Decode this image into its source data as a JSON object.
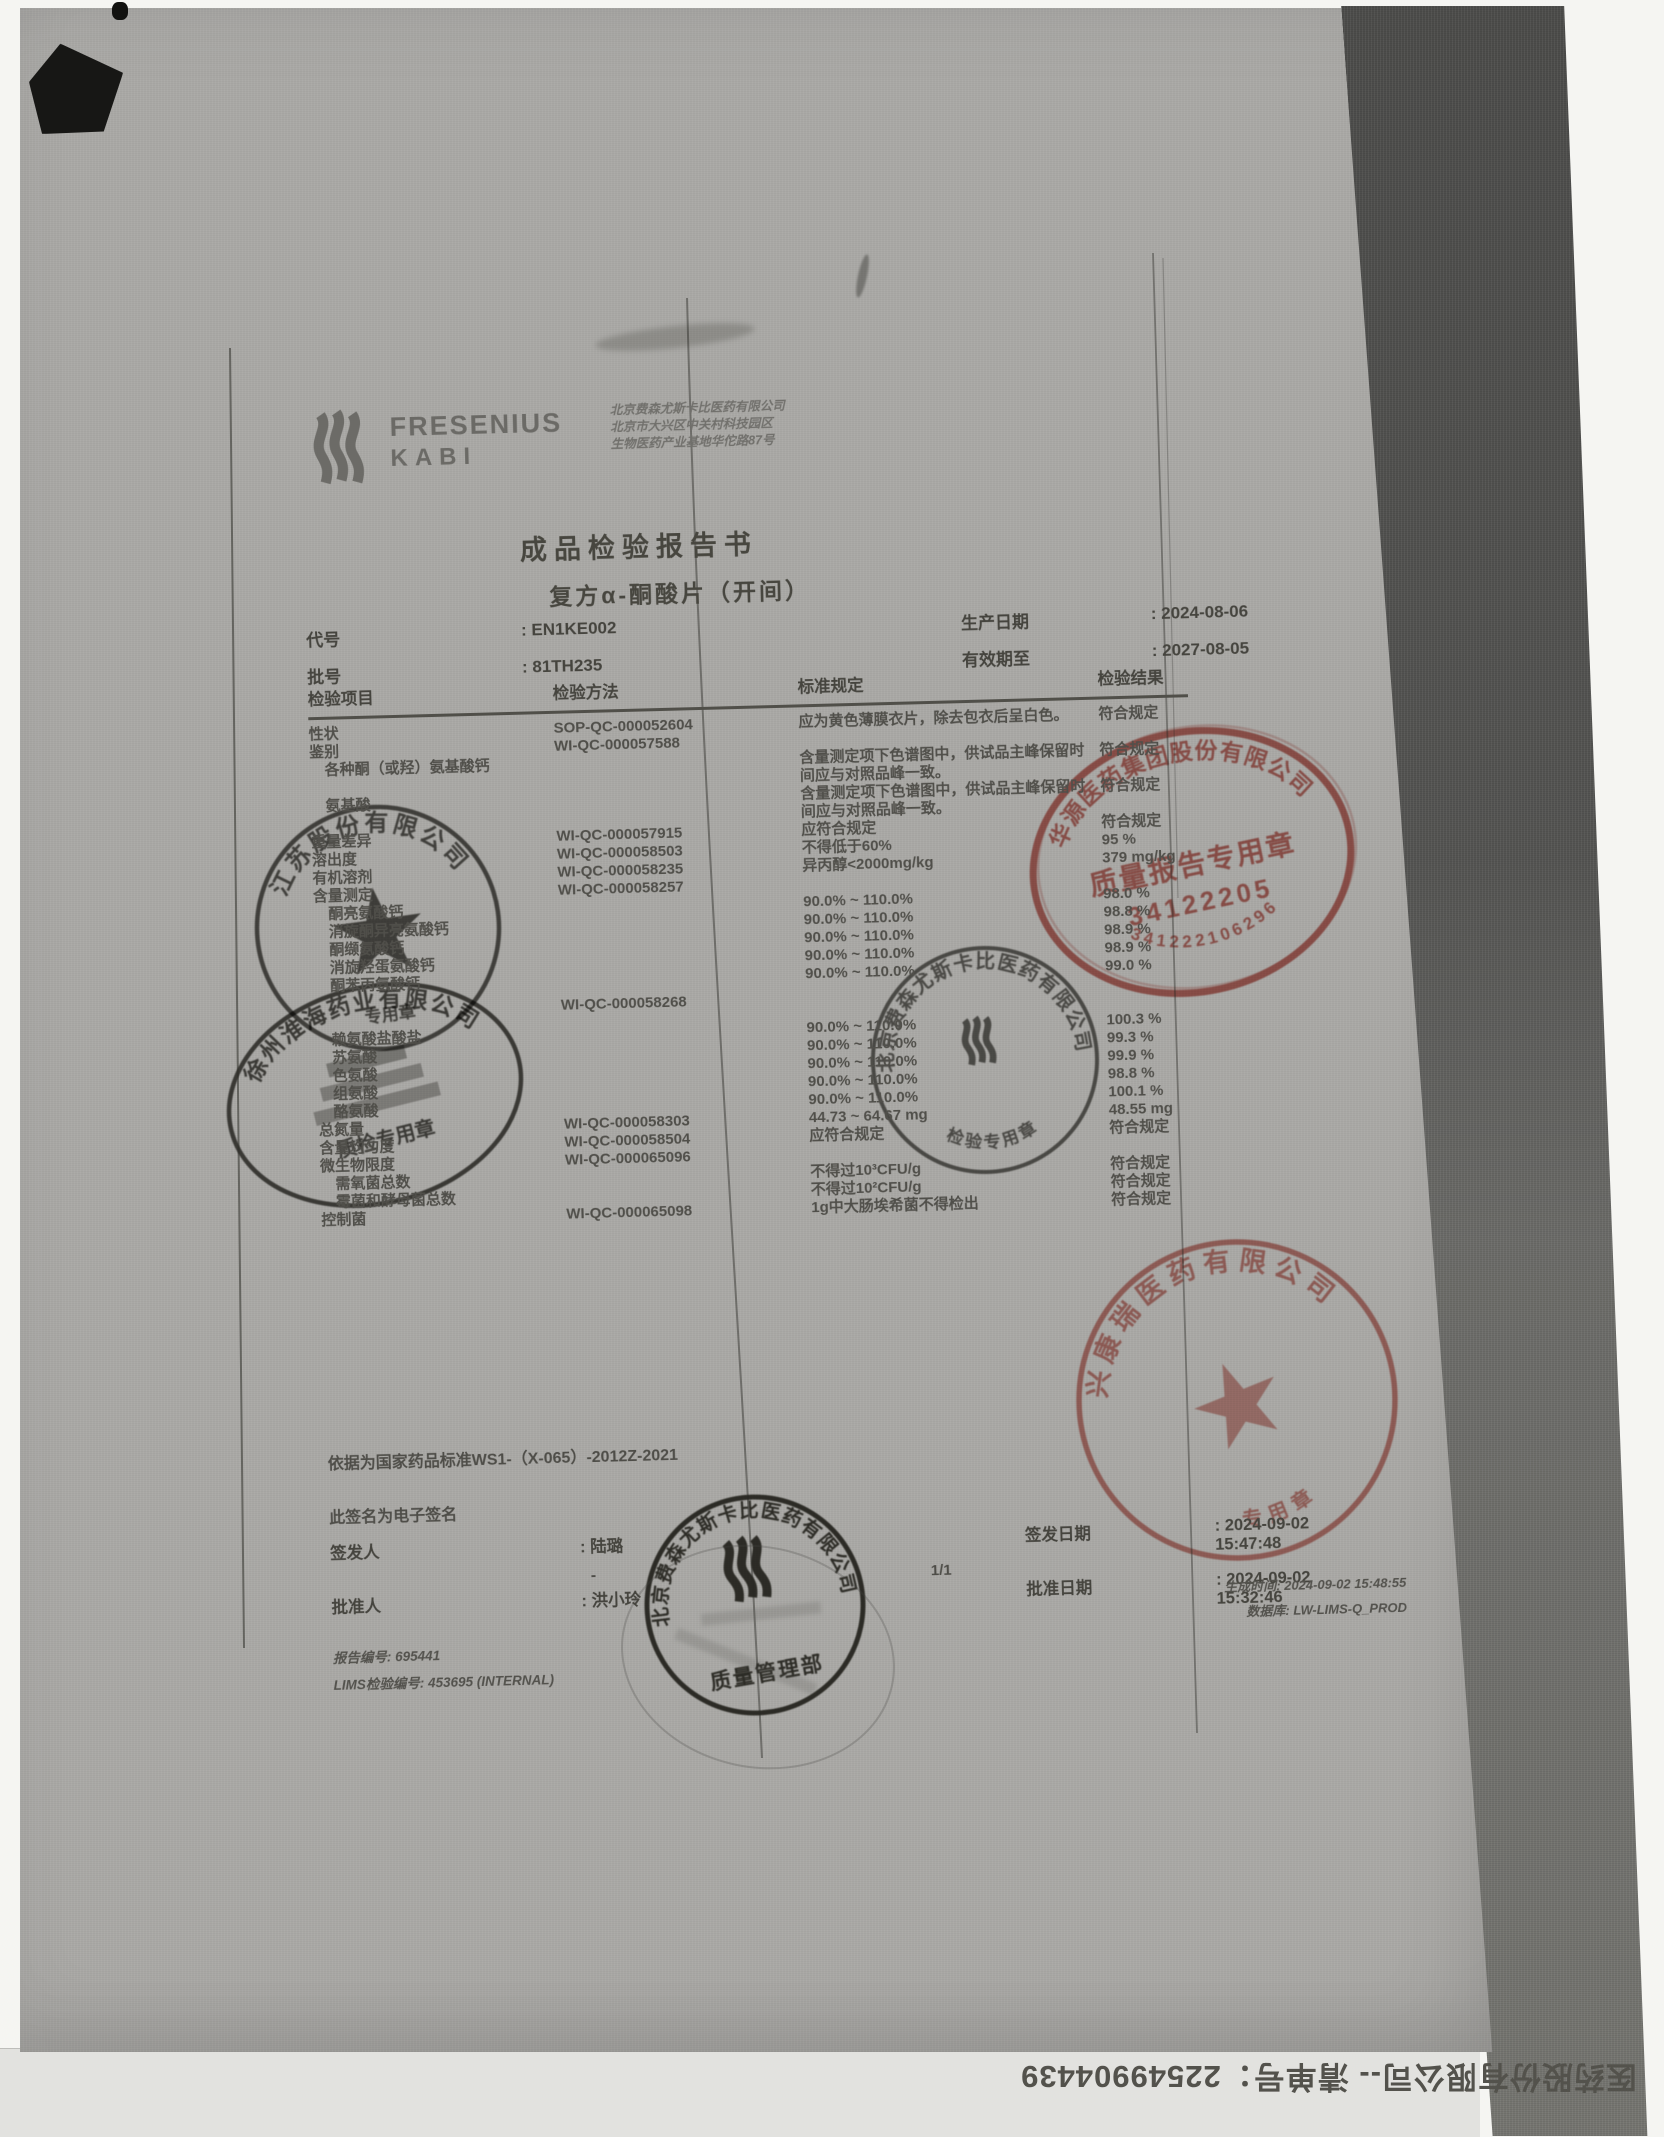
{
  "colors": {
    "paper": "#a9a8a5",
    "stamp_red": "#c0544b",
    "stamp_black": "#44433e"
  },
  "header": {
    "logo_word1": "FRESENIUS",
    "logo_word2": "KABI",
    "company_lines": [
      "北京费森尤斯卡比医药有限公司",
      "北京市大兴区中关村科技园区",
      "生物医药产业基地华佗路87号"
    ],
    "title": "成品检验报告书",
    "subtitle": "复方α-酮酸片（开间）"
  },
  "meta": {
    "code_label": "代号",
    "code_value": ": EN1KE002",
    "batch_label": "批号",
    "batch_value": ": 81TH235",
    "mfg_label": "生产日期",
    "mfg_value": ": 2024-08-06",
    "exp_label": "有效期至",
    "exp_value": ": 2027-08-05"
  },
  "table": {
    "headers": [
      "检验项目",
      "检验方法",
      "标准规定",
      "检验结果"
    ],
    "rows": [
      {
        "item": "性状",
        "method": "SOP-QC-000052604",
        "standard": "应为黄色薄膜衣片，除去包衣后呈白色。",
        "result": "符合规定"
      },
      {
        "item": "鉴别",
        "method": "WI-QC-000057588",
        "standard": "",
        "result": ""
      },
      {
        "item": "　各种酮（或羟）氨基酸钙",
        "method": "",
        "standard": "含量测定项下色谱图中，供试品主峰保留时间应与对照品峰一致。",
        "result": "符合规定"
      },
      {
        "item": "　氨基酸",
        "method": "",
        "standard": "含量测定项下色谱图中，供试品主峰保留时间应与对照品峰一致。",
        "result": "符合规定"
      },
      {
        "item": "重量差异",
        "method": "WI-QC-000057915",
        "standard": "应符合规定",
        "result": "符合规定"
      },
      {
        "item": "溶出度",
        "method": "WI-QC-000058503",
        "standard": "不得低于60%",
        "result": "95 %"
      },
      {
        "item": "有机溶剂",
        "method": "WI-QC-000058235",
        "standard": "异丙醇<2000mg/kg",
        "result": "379 mg/kg"
      },
      {
        "item": "含量测定",
        "method": "WI-QC-000058257",
        "standard": "",
        "result": ""
      },
      {
        "item": "　酮亮氨酸钙",
        "method": "",
        "standard": "90.0% ~ 110.0%",
        "result": "98.0 %"
      },
      {
        "item": "　消旋酮异亮氨酸钙",
        "method": "",
        "standard": "90.0% ~ 110.0%",
        "result": "98.8 %"
      },
      {
        "item": "　酮缬氨酸钙",
        "method": "",
        "standard": "90.0% ~ 110.0%",
        "result": "98.9 %"
      },
      {
        "item": "　消旋羟蛋氨酸钙",
        "method": "",
        "standard": "90.0% ~ 110.0%",
        "result": "98.9 %"
      },
      {
        "item": "　酮苯丙氨酸钙",
        "method": "",
        "standard": "90.0% ~ 110.0%",
        "result": "99.0 %"
      },
      {
        "item": "",
        "method": "WI-QC-000058268",
        "standard": "",
        "result": ""
      },
      {
        "item": "　赖氨酸盐酸盐",
        "method": "",
        "standard": "90.0% ~ 110.0%",
        "result": "100.3 %"
      },
      {
        "item": "　苏氨酸",
        "method": "",
        "standard": "90.0% ~ 110.0%",
        "result": "99.3 %"
      },
      {
        "item": "　色氨酸",
        "method": "",
        "standard": "90.0% ~ 110.0%",
        "result": "99.9 %"
      },
      {
        "item": "　组氨酸",
        "method": "",
        "standard": "90.0% ~ 110.0%",
        "result": "98.8 %"
      },
      {
        "item": "　酪氨酸",
        "method": "",
        "standard": "90.0% ~ 110.0%",
        "result": "100.1 %"
      },
      {
        "item": "总氮量",
        "method": "WI-QC-000058303",
        "standard": "44.73 ~ 64.67 mg",
        "result": "48.55 mg"
      },
      {
        "item": "含量均匀度",
        "method": "WI-QC-000058504",
        "standard": "应符合规定",
        "result": "符合规定"
      },
      {
        "item": "微生物限度",
        "method": "WI-QC-000065096",
        "standard": "",
        "result": ""
      },
      {
        "item": "　需氧菌总数",
        "method": "",
        "standard": "不得过10³CFU/g",
        "result": "符合规定"
      },
      {
        "item": "　霉菌和酵母菌总数",
        "method": "",
        "standard": "不得过10²CFU/g",
        "result": "符合规定"
      },
      {
        "item": "控制菌",
        "method": "WI-QC-000065098",
        "standard": "1g中大肠埃希菌不得检出",
        "result": "符合规定"
      }
    ]
  },
  "footer": {
    "basis": "依据为国家药品标准WS1-（X-065）-2012Z-2021",
    "esign_note": "此签名为电子签名",
    "issuer_label": "签发人",
    "issuer_value": ": 陆璐",
    "issuer_dash": "-",
    "issue_date_label": "签发日期",
    "issue_date_value": ": 2024-09-02 15:47:48",
    "approver_label": "批准人",
    "approver_value": ": 洪小玲",
    "approve_date_label": "批准日期",
    "approve_date_value": ": 2024-09-02 15:32:46",
    "report_no": "报告编号: 695441",
    "lims_no": "LIMS检验编号: 453695 (INTERNAL)",
    "page": "1/1",
    "gen_time": "生成时间: 2024-09-02 15:48:55",
    "database": "数据库: LW-LIMS-Q_PROD"
  },
  "stamps": {
    "black_star": {
      "arc": "江苏股份有限公司",
      "bottom": "专用章"
    },
    "black_oval": {
      "arc": "徐州淮海药业有限公司",
      "center": "质检专用章"
    },
    "black_fk_qc": {
      "arc": "北京费森尤斯卡比医药有限公司",
      "bottom": "检验专用章"
    },
    "black_fk_qm": {
      "arc": "北京费森尤斯卡比医药有限公司",
      "bottom": "质量管理部"
    },
    "red_oval": {
      "arc": "华源医药集团股份有限公司",
      "line1": "质量报告专用章",
      "line2": "34122205",
      "bottom": "341222106296"
    },
    "red_star": {
      "arc": "兴康瑞医药有限公司",
      "bottom": "专用章"
    }
  },
  "bottom_reversed_text": "医药股份有限公司-- 清单号：22549904439"
}
